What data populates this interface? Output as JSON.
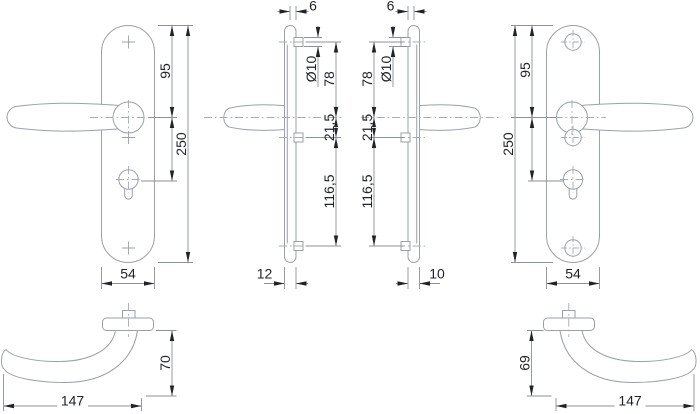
{
  "document": {
    "type": "technical drawing",
    "subject": "door handle set with long backplates - dimensioned views"
  },
  "colors": {
    "background": "#ffffff",
    "outline": "#9aa1a8",
    "centerline": "#a6acb3",
    "dimension_line": "#8c929a",
    "text": "#20242a",
    "arrow": "#20242a"
  },
  "views": {
    "left_front": {
      "label": "left backplate front view",
      "dims": {
        "top_to_handle": "95",
        "total_height": "250",
        "plate_width": "54"
      }
    },
    "left_profile": {
      "label": "left set side profile",
      "dims": {
        "top_offset": "6",
        "hole_diameter": "Ø10",
        "top_hole_to_handle": "78",
        "handle_to_mid_hole": "21,5",
        "mid_to_bottom_hole": "116,5",
        "plate_thickness": "12"
      }
    },
    "right_profile": {
      "label": "right set side profile",
      "dims": {
        "top_offset": "6",
        "hole_diameter": "Ø10",
        "top_hole_to_handle": "78",
        "handle_to_mid_hole": "21,5",
        "mid_to_bottom_hole": "116,5",
        "plate_thickness": "10"
      }
    },
    "right_front": {
      "label": "right backplate front view",
      "dims": {
        "top_to_handle": "95",
        "total_height": "250",
        "plate_width": "54"
      }
    },
    "left_grip_top": {
      "label": "left lever top view",
      "dims": {
        "projection": "70",
        "length": "147"
      }
    },
    "right_grip_top": {
      "label": "right lever top view",
      "dims": {
        "projection": "69",
        "length": "147"
      }
    }
  }
}
